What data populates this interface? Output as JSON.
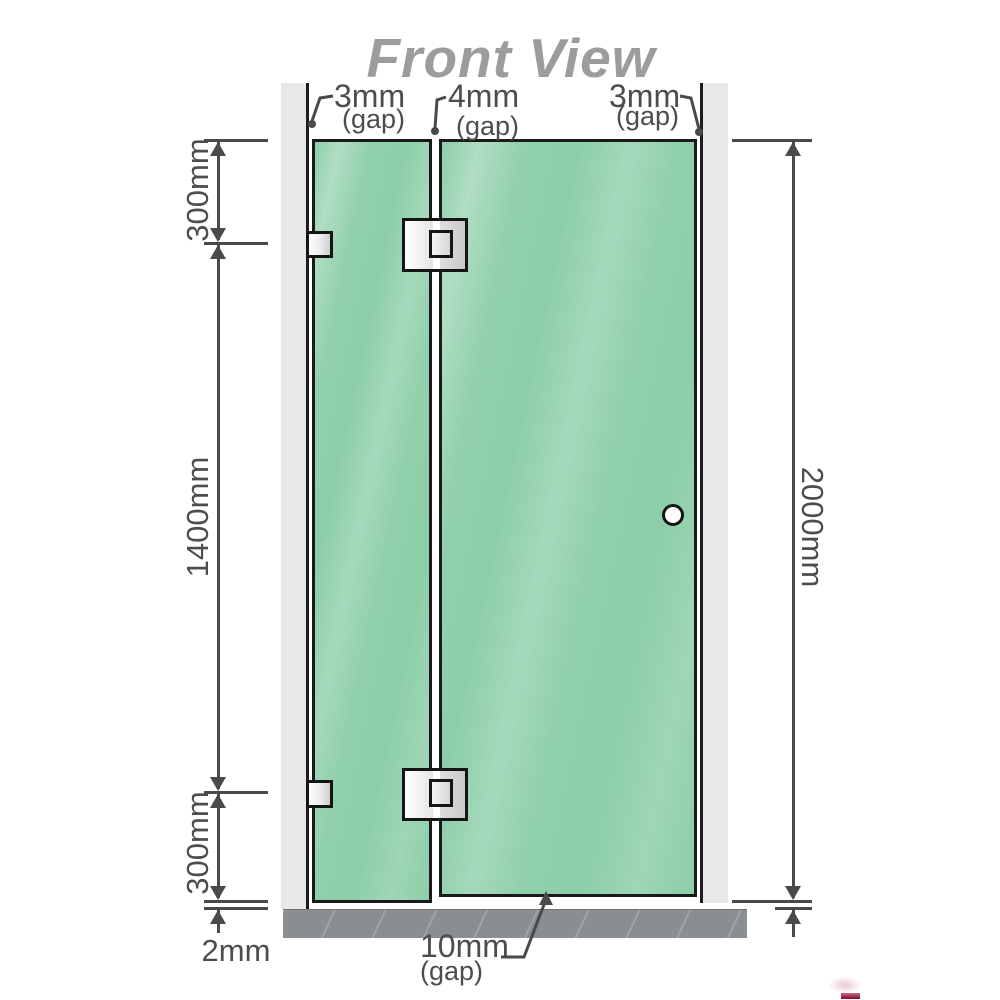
{
  "title": "Front View",
  "gaps": {
    "top_left": {
      "value": "3mm",
      "note": "(gap)"
    },
    "top_middle": {
      "value": "4mm",
      "note": "(gap)"
    },
    "top_right": {
      "value": "3mm",
      "note": "(gap)"
    },
    "bottom": {
      "value": "10mm",
      "note": "(gap)"
    },
    "floor": {
      "value": "2mm"
    }
  },
  "dimensions": {
    "left_top": "300mm",
    "left_middle": "1400mm",
    "left_bottom": "300mm",
    "right_height": "2000mm"
  },
  "colors": {
    "glass": "#8CCEA8",
    "glass_highlight": "#AADDBE",
    "wall": "#E8E8E8",
    "floor": "#8B8E91",
    "line": "#4A4A4A",
    "title_gray": "#9C9C9C",
    "hardware_silver": "#E3E3E3",
    "watermark_red": "#7C0A28"
  }
}
